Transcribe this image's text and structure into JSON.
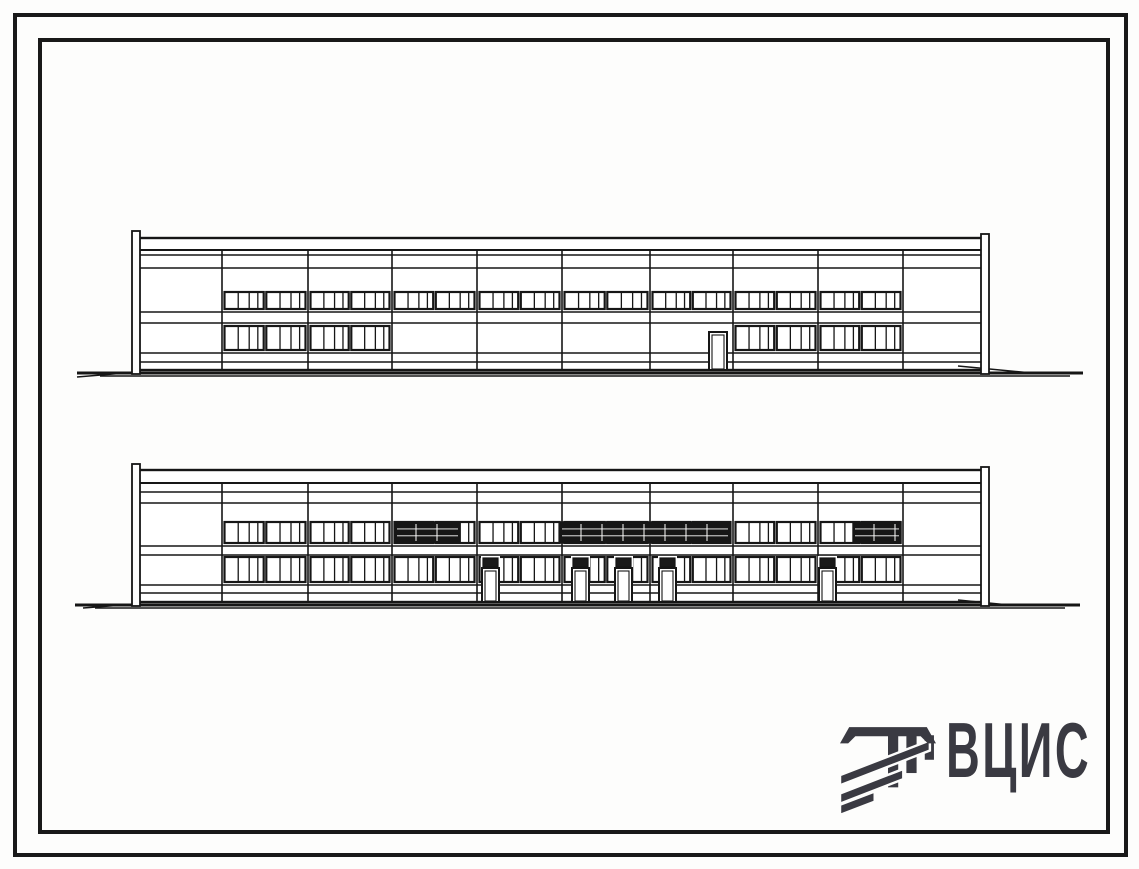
{
  "sheet": {
    "background": "#fdfdfc",
    "ink": "#161616",
    "outer_frame": {
      "stroke_px": 4
    },
    "inner_frame": {
      "stroke_px": 4
    }
  },
  "logo": {
    "text": "ВЦИС",
    "color": "#3a3a42"
  },
  "drawings": {
    "top": {
      "origin": {
        "left": 75,
        "top": 228
      },
      "width": 1012,
      "height": 156,
      "face": {
        "x0": 62,
        "x1": 913,
        "top": 10,
        "bottom": 142
      },
      "fascia": [
        22
      ],
      "hlines": [
        27,
        40,
        84,
        95,
        125,
        134
      ],
      "bays": [
        62,
        147,
        233,
        317,
        402,
        487,
        575,
        658,
        743,
        828,
        913
      ],
      "posts": [
        {
          "x": 57,
          "w": 8,
          "top": 3
        },
        {
          "x": 906,
          "w": 8,
          "top": 6
        }
      ],
      "upper_band": {
        "y0": 64,
        "y1": 81,
        "segments": [
          [
            147,
            828
          ]
        ],
        "dark": []
      },
      "lower_band": {
        "y0": 98,
        "y1": 122,
        "segments": [
          [
            147,
            317
          ],
          [
            658,
            828
          ]
        ],
        "dark": []
      },
      "doors": [
        {
          "x": 634,
          "w": 18,
          "top": 104,
          "transom": 0
        }
      ],
      "ground": {
        "y": 145,
        "x0": 2,
        "x1": 1008,
        "second": {
          "y": 148,
          "x0": 25,
          "x1": 995
        },
        "left_ramp": [
          2,
          149,
          62,
          144
        ],
        "right_ramp": [
          883,
          138,
          957,
          145
        ]
      }
    },
    "bottom": {
      "origin": {
        "left": 75,
        "top": 462
      },
      "width": 1012,
      "height": 152,
      "face": {
        "x0": 62,
        "x1": 913,
        "top": 8,
        "bottom": 140
      },
      "fascia": [
        21
      ],
      "hlines": [
        30,
        41,
        84,
        93,
        123,
        131
      ],
      "bays": [
        62,
        147,
        233,
        317,
        402,
        487,
        575,
        658,
        743,
        828,
        913
      ],
      "posts": [
        {
          "x": 57,
          "w": 8,
          "top": 2
        },
        {
          "x": 906,
          "w": 8,
          "top": 5
        }
      ],
      "upper_band": {
        "y0": 60,
        "y1": 81,
        "segments": [
          [
            147,
            828
          ]
        ],
        "dark": [
          [
            320,
            385
          ],
          [
            485,
            655
          ],
          [
            778,
            826
          ]
        ]
      },
      "lower_band": {
        "y0": 95,
        "y1": 120,
        "segments": [
          [
            147,
            828
          ]
        ],
        "dark": []
      },
      "doors": [
        {
          "x": 407,
          "w": 17,
          "top": 95,
          "transom": 9
        },
        {
          "x": 497,
          "w": 17,
          "top": 95,
          "transom": 9
        },
        {
          "x": 540,
          "w": 17,
          "top": 95,
          "transom": 9
        },
        {
          "x": 584,
          "w": 17,
          "top": 95,
          "transom": 9
        },
        {
          "x": 744,
          "w": 17,
          "top": 95,
          "transom": 9
        }
      ],
      "ground": {
        "y": 143,
        "x0": 0,
        "x1": 1005,
        "second": {
          "y": 146,
          "x0": 20,
          "x1": 990
        },
        "left_ramp": [
          8,
          146,
          62,
          142
        ],
        "right_ramp": [
          883,
          138,
          934,
          143
        ]
      }
    }
  }
}
